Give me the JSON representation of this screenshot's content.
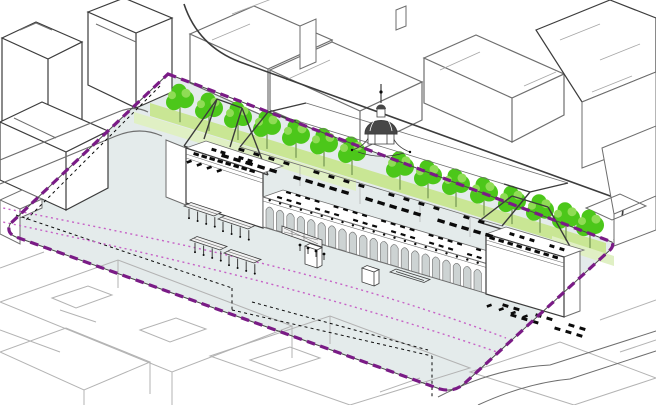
{
  "colors": {
    "background": "#FFFFFF",
    "site_fill": "#E4EBEB",
    "boundary_purple": "#7A1B86",
    "boundary_underlay": "#4A4A4A",
    "track_pink": "#C661C6",
    "tree_green": "#4CC71A",
    "tree_light": "#8FDC55",
    "strip_green": "#C9E694",
    "strip_pale": "#E0F0C4",
    "outline_dark": "#3C3C3C",
    "outline_mid": "#6E6E6E",
    "outline_light": "#A6A6A6",
    "ghost_gray": "#B3B3B3",
    "detail_black": "#0B0B0B",
    "dome_gray": "#474747",
    "arch_shade": "#CDD3D3"
  },
  "scene": {
    "site": {
      "boundary_style": "dashed",
      "inner_black_dotted_lines": 2,
      "pink_dotted_track_lines": 2
    },
    "vegetation": {
      "tree_count": 15,
      "planting_strips": 3
    },
    "building": {
      "arch_count": 21,
      "pavilion_count": 2,
      "has_dome_clocktower": true,
      "ghost_roof": true,
      "plan_wall_dash_bands": 6
    },
    "furniture": {
      "platform_canopy_count": 4,
      "has_escalator": true,
      "kiosk_count": 1,
      "pin_count": 4
    }
  }
}
